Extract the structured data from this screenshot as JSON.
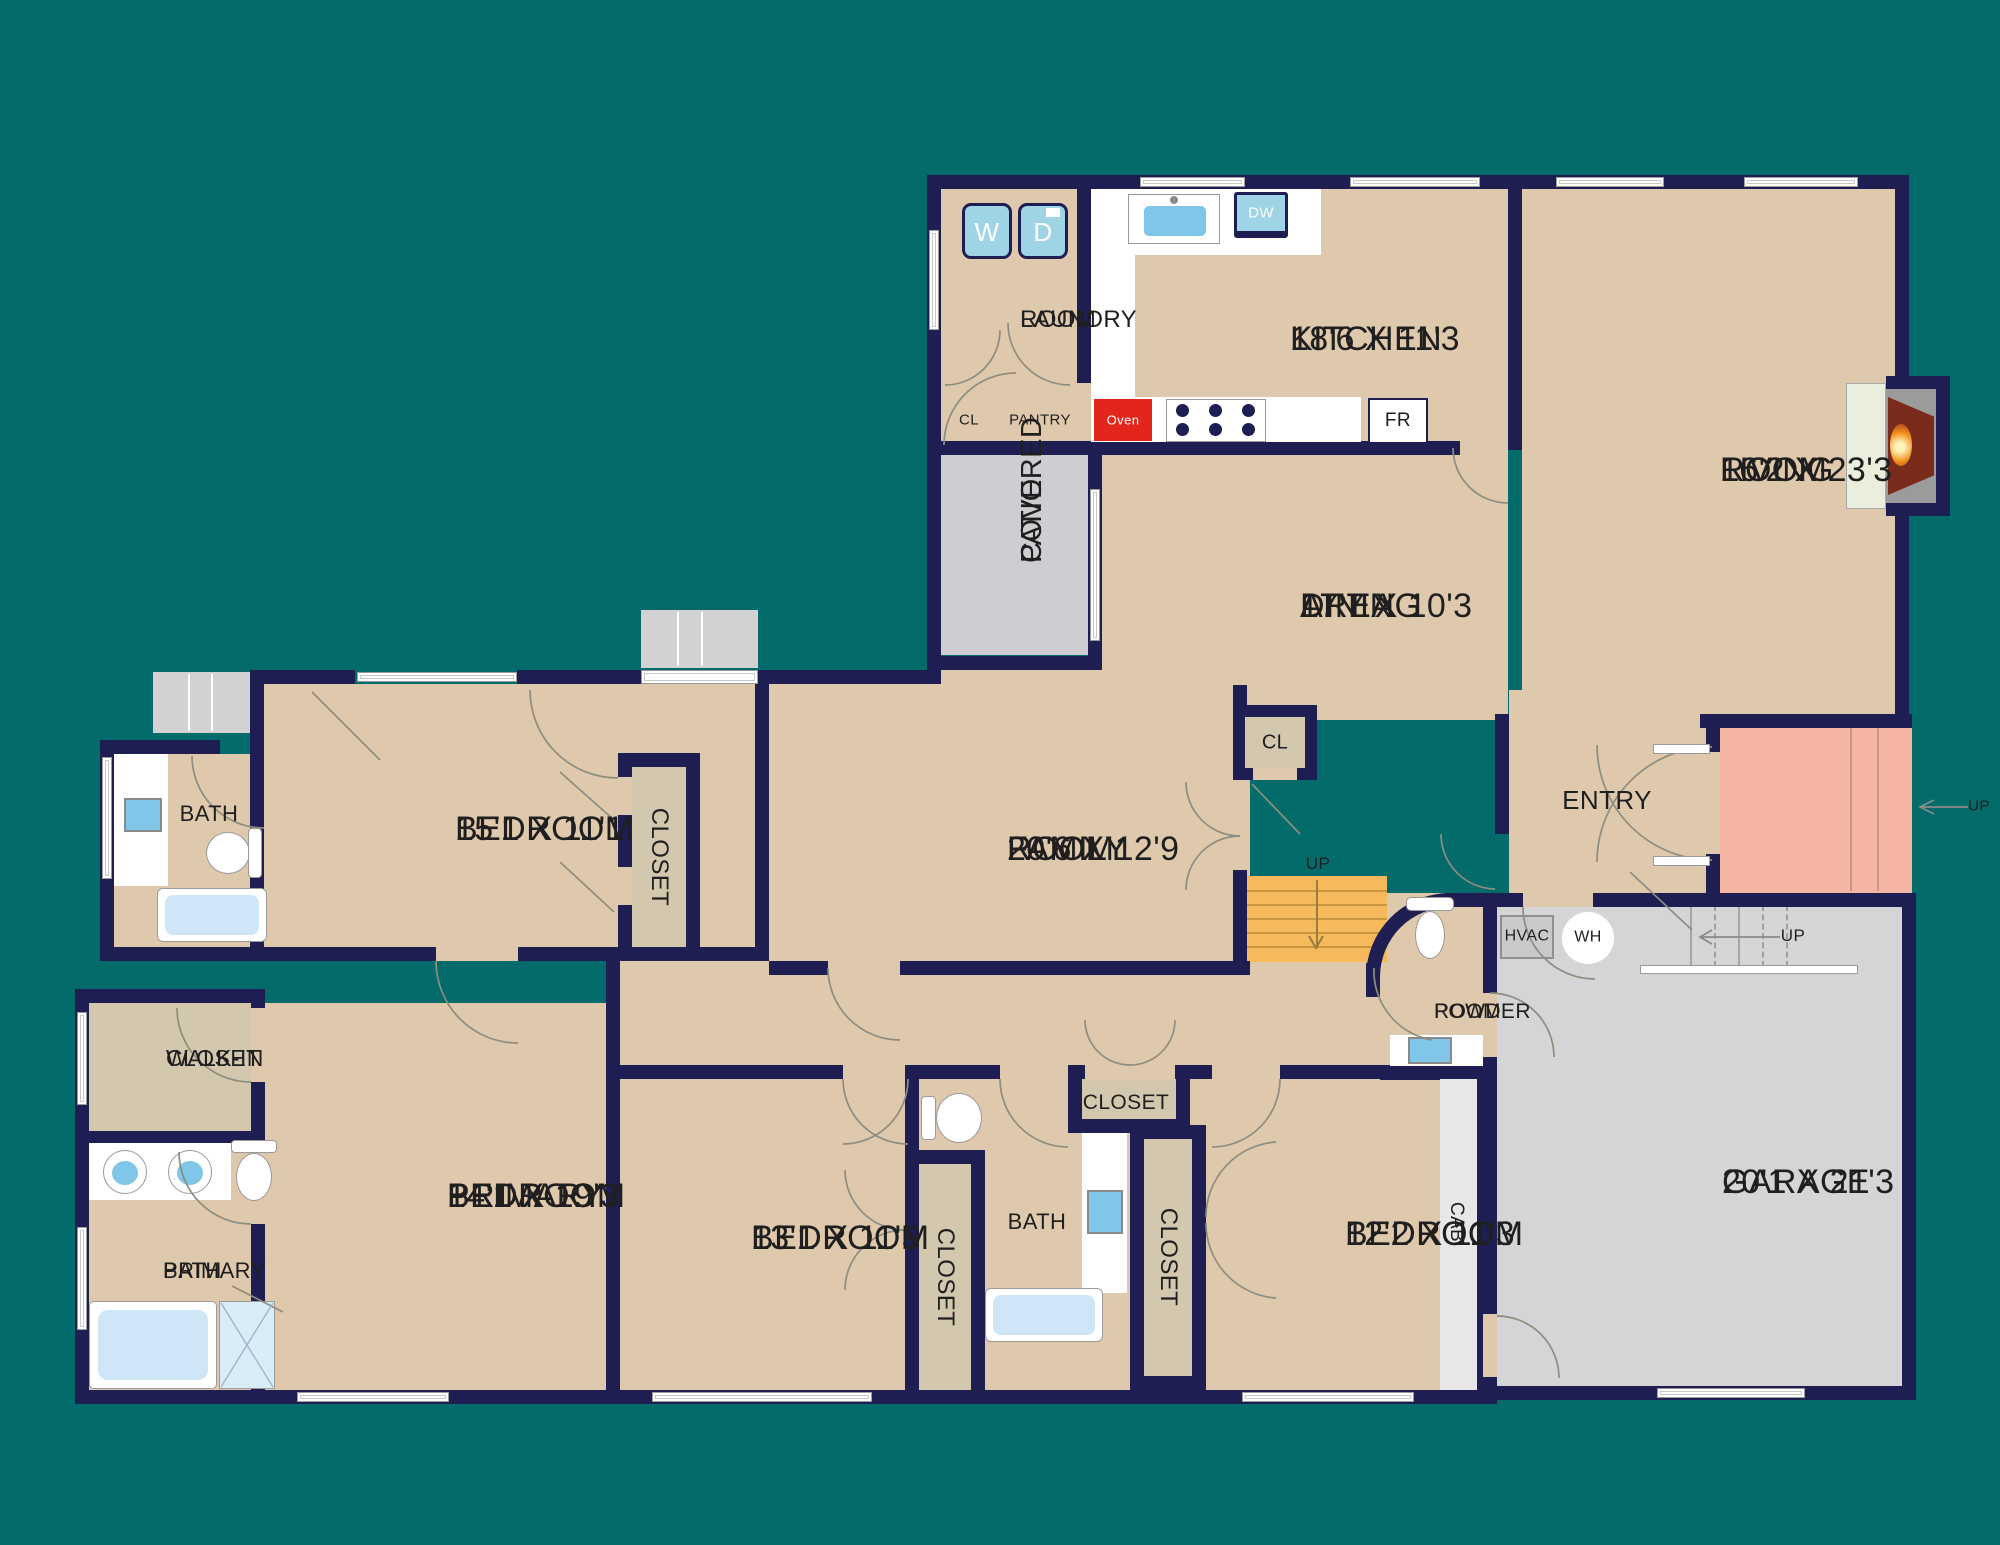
{
  "palette": {
    "background": "#046B6B",
    "wall": "#1E1E52",
    "floor": "#DFC9AC",
    "closet": "#D3C8AE",
    "counter": "#FFFFFF",
    "garage": "#D5D5D8",
    "patio": "#CDCED1",
    "deck": "#D2D2D5",
    "porch": "#F4B5A3",
    "stairs": "#F6BA5D",
    "appliance": "#9ED4E6",
    "water": "#7FC6E8",
    "oven_red": "#E3261B",
    "hearth": "#E9EFDC",
    "firebox_gray": "#9B9B9B",
    "fire_brown": "#7A2B1C",
    "line": "#8D8D80",
    "text": "#1F1F1F"
  },
  "rooms": {
    "laundry": {
      "l1": "LAUNDRY",
      "l2": "ROOM"
    },
    "kitchen": {
      "name": "KITCHEN",
      "dims": "18'6 X 11'3"
    },
    "living": {
      "l1": "LIVING",
      "l2": "ROOM",
      "dims": "16'2 X 23'3"
    },
    "dining": {
      "l1": "DINING",
      "l2": "AREA",
      "dims": "17'7 X 10'3"
    },
    "patio": {
      "l1": "COVERED",
      "l2": "PATIO"
    },
    "family": {
      "l1": "FAMILY",
      "l2": "ROOM",
      "dims": "20'6 X 12'9"
    },
    "entry": {
      "name": "ENTRY"
    },
    "bedroom1": {
      "name": "BEDROOM",
      "dims": "15'1 X 11'1"
    },
    "bath1": {
      "name": "BATH"
    },
    "walkin": {
      "l1": "WALK-IN",
      "l2": "CLOSET"
    },
    "primary_bath": {
      "l1": "PRIMARY",
      "l2": "BATH"
    },
    "primary_bedroom": {
      "l1": "PRIMARY",
      "l2": "BEDROOM",
      "dims": "14'1 X 19'3"
    },
    "bedroom2": {
      "name": "BEDROOM",
      "dims": "13'1 X 11'3"
    },
    "bath2": {
      "name": "BATH"
    },
    "bedroom3": {
      "name": "BEDROOM",
      "dims": "12'2 X 11'3"
    },
    "powder": {
      "l1": "POWDER",
      "l2": "ROOM"
    },
    "garage": {
      "name": "GARAGE",
      "dims": "20'1 X 21'3"
    }
  },
  "labels": {
    "closet": "CLOSET",
    "cl": "CL",
    "pantry": "PANTRY",
    "cab": "CAB",
    "hvac": "HVAC",
    "water_heater": "WH",
    "washer": "W",
    "dryer": "D",
    "dishwasher": "DW",
    "fridge": "FR",
    "oven": "Oven",
    "up": "UP"
  }
}
